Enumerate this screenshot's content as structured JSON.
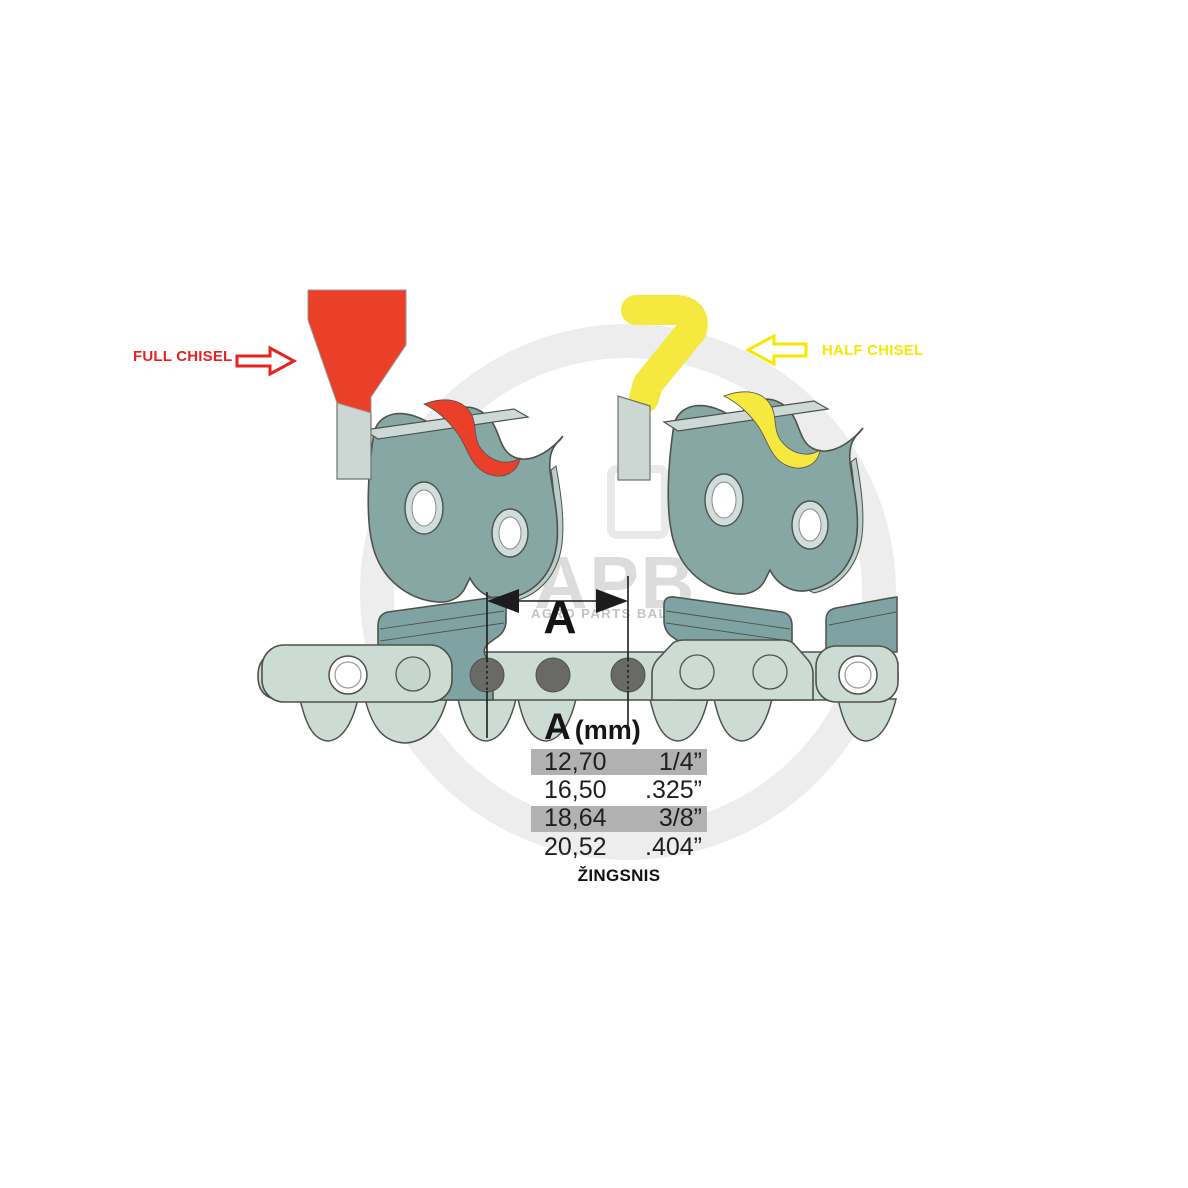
{
  "illustration": {
    "full_chisel_label": "FULL CHISEL",
    "half_chisel_label": "HALF CHISEL",
    "dimension_label": "A"
  },
  "pitch_table": {
    "header_symbol": "A",
    "header_unit": "(mm)",
    "rows": [
      {
        "mm": "12,70",
        "inches": "1/4”",
        "highlighted": true
      },
      {
        "mm": "16,50",
        "inches": ".325”",
        "highlighted": false
      },
      {
        "mm": "18,64",
        "inches": "3/8”",
        "highlighted": true
      },
      {
        "mm": "20,52",
        "inches": ".404”",
        "highlighted": false
      }
    ],
    "caption": "ŽINGSNIS"
  },
  "watermark": {
    "brand": "APB",
    "subtitle": "AGRO PARTS BALTIJA"
  },
  "colors": {
    "full_chisel_text": "#e8231f",
    "full_chisel_fill": "#ea3f28",
    "half_chisel_text": "#f7e800",
    "half_chisel_fill": "#f5e93f",
    "link_plate": "#87a7a5",
    "chain_light": "#ccdcd5",
    "chain_cutter": "#7fa3a2",
    "rivet_dark": "#696a66",
    "row_highlight": "#b1b1b1",
    "watermark_gray": "#ededed"
  }
}
